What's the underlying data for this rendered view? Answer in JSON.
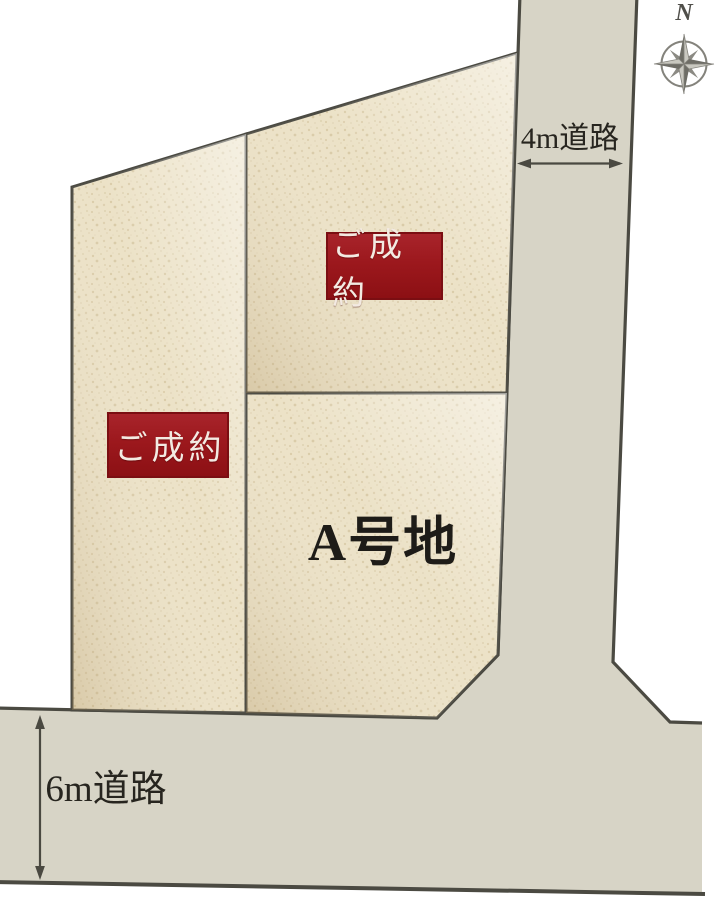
{
  "diagram": {
    "compass_label": "N",
    "roads": {
      "vertical_label": "4m道路",
      "horizontal_label": "6m道路"
    },
    "lots": [
      {
        "name": "west-lot",
        "status": "ご成約"
      },
      {
        "name": "northeast-lot",
        "status": "ご成約"
      },
      {
        "name": "lot-a",
        "label": "A号地"
      }
    ],
    "colors": {
      "lot_fill": "#ece2c7",
      "lot_speckle": "#d7c8a4",
      "road_fill": "#d7d4c6",
      "outline": "#4b4a42",
      "sold_badge_bg": "#9c181d",
      "sold_badge_border": "#7b0e12",
      "sold_badge_text": "#f3eae2",
      "label_text": "#27251f",
      "compass_gray": "#84837c"
    }
  }
}
